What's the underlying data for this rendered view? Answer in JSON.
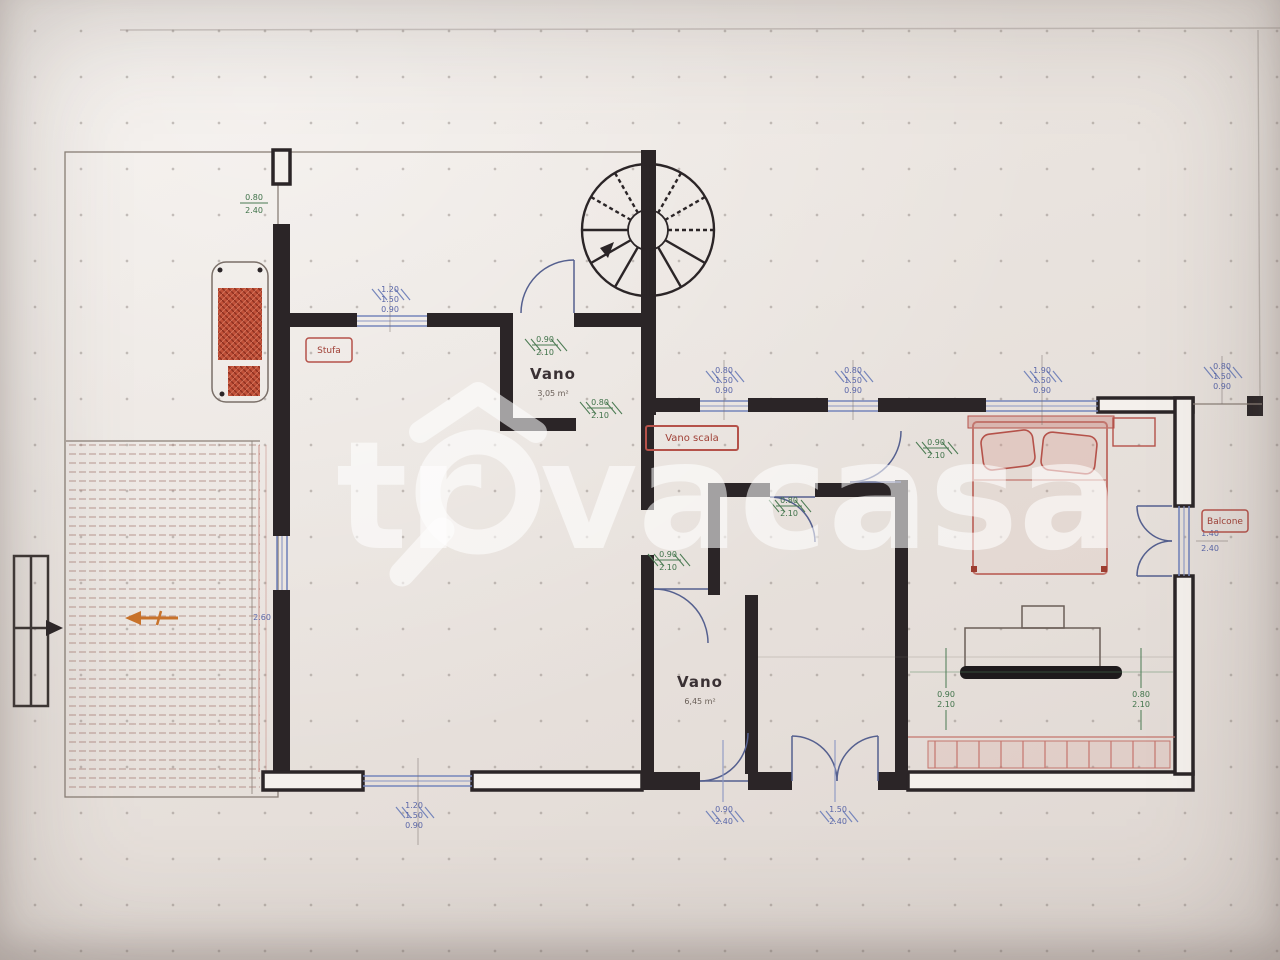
{
  "watermark": {
    "prefix": "tr",
    "suffix": "vacasa",
    "full": "trovacasa"
  },
  "rooms": {
    "vano_upper": {
      "name": "Vano",
      "area": "3,05 m²"
    },
    "vano_lower": {
      "name": "Vano",
      "area": "6,45 m²"
    }
  },
  "labels": {
    "stove": "Stufa",
    "stair": "Vano scala",
    "balcony": "Balcone"
  },
  "dims": {
    "entry": [
      "0.80",
      "2.40"
    ],
    "living_top_window": [
      "1.20",
      "1.50",
      "0.90"
    ],
    "living_left": [
      "2.60"
    ],
    "living_bottom_window": [
      "1.20",
      "1.50",
      "0.90"
    ],
    "vano_upper_door": [
      "0.90",
      "2.10"
    ],
    "vano_upper_pass": [
      "0.80",
      "2.10"
    ],
    "living_pass": [
      "0.90",
      "2.10"
    ],
    "hall_window_a": [
      "0.80",
      "1.50",
      "0.90"
    ],
    "hall_window_b": [
      "0.80",
      "1.50",
      "0.90"
    ],
    "hall_door": [
      "0.80",
      "2.10"
    ],
    "bedroom_door": [
      "0.90",
      "2.10"
    ],
    "bedroom_window": [
      "1.90",
      "1.50",
      "0.90"
    ],
    "right_top_window": [
      "0.80",
      "1.50",
      "0.90"
    ],
    "right_window": [
      "1.40",
      "2.40"
    ],
    "bedroom_left_v": [
      "0.90",
      "2.10"
    ],
    "bedroom_right_v": [
      "0.80",
      "2.10"
    ],
    "bottom_door": [
      "0.90",
      "2.40"
    ],
    "bottom_french": [
      "1.50",
      "2.40"
    ]
  },
  "colors": {
    "wall": "#2b2527",
    "window_blue": "#7585bb",
    "dim_green": "#3f7249",
    "furniture_red": "#b5524a",
    "watermark": "#ffffff",
    "paper": "#e8e2dd"
  }
}
